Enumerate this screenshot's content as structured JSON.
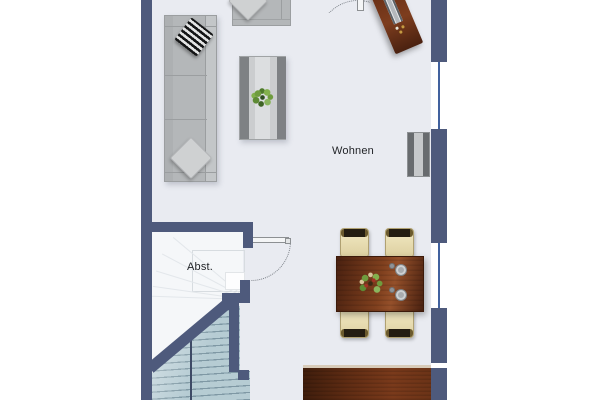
{
  "plan": {
    "room_label": "Wohnen",
    "storage_label": "Abst."
  },
  "colors": {
    "wall": "#4e5a7c",
    "floor": "#e9ebf1",
    "storage-floor": "#f5f7f9",
    "stairs": "#b2c9d1",
    "winder-line": "#e3e7eb",
    "rail": "#3e4a66",
    "window": "#41619e",
    "sofa": "#b4b7b9",
    "sofa-light": "#c3c6c8",
    "outline": "#9b9ea0",
    "table-gray": "#cbcdcf",
    "table-gray-dark": "#7e8184",
    "wood": "#7a3a1b",
    "wood-dark": "#55260f",
    "chair": "#ecdfb4",
    "chair-trim": "#241d12",
    "text": "#1f2125"
  }
}
